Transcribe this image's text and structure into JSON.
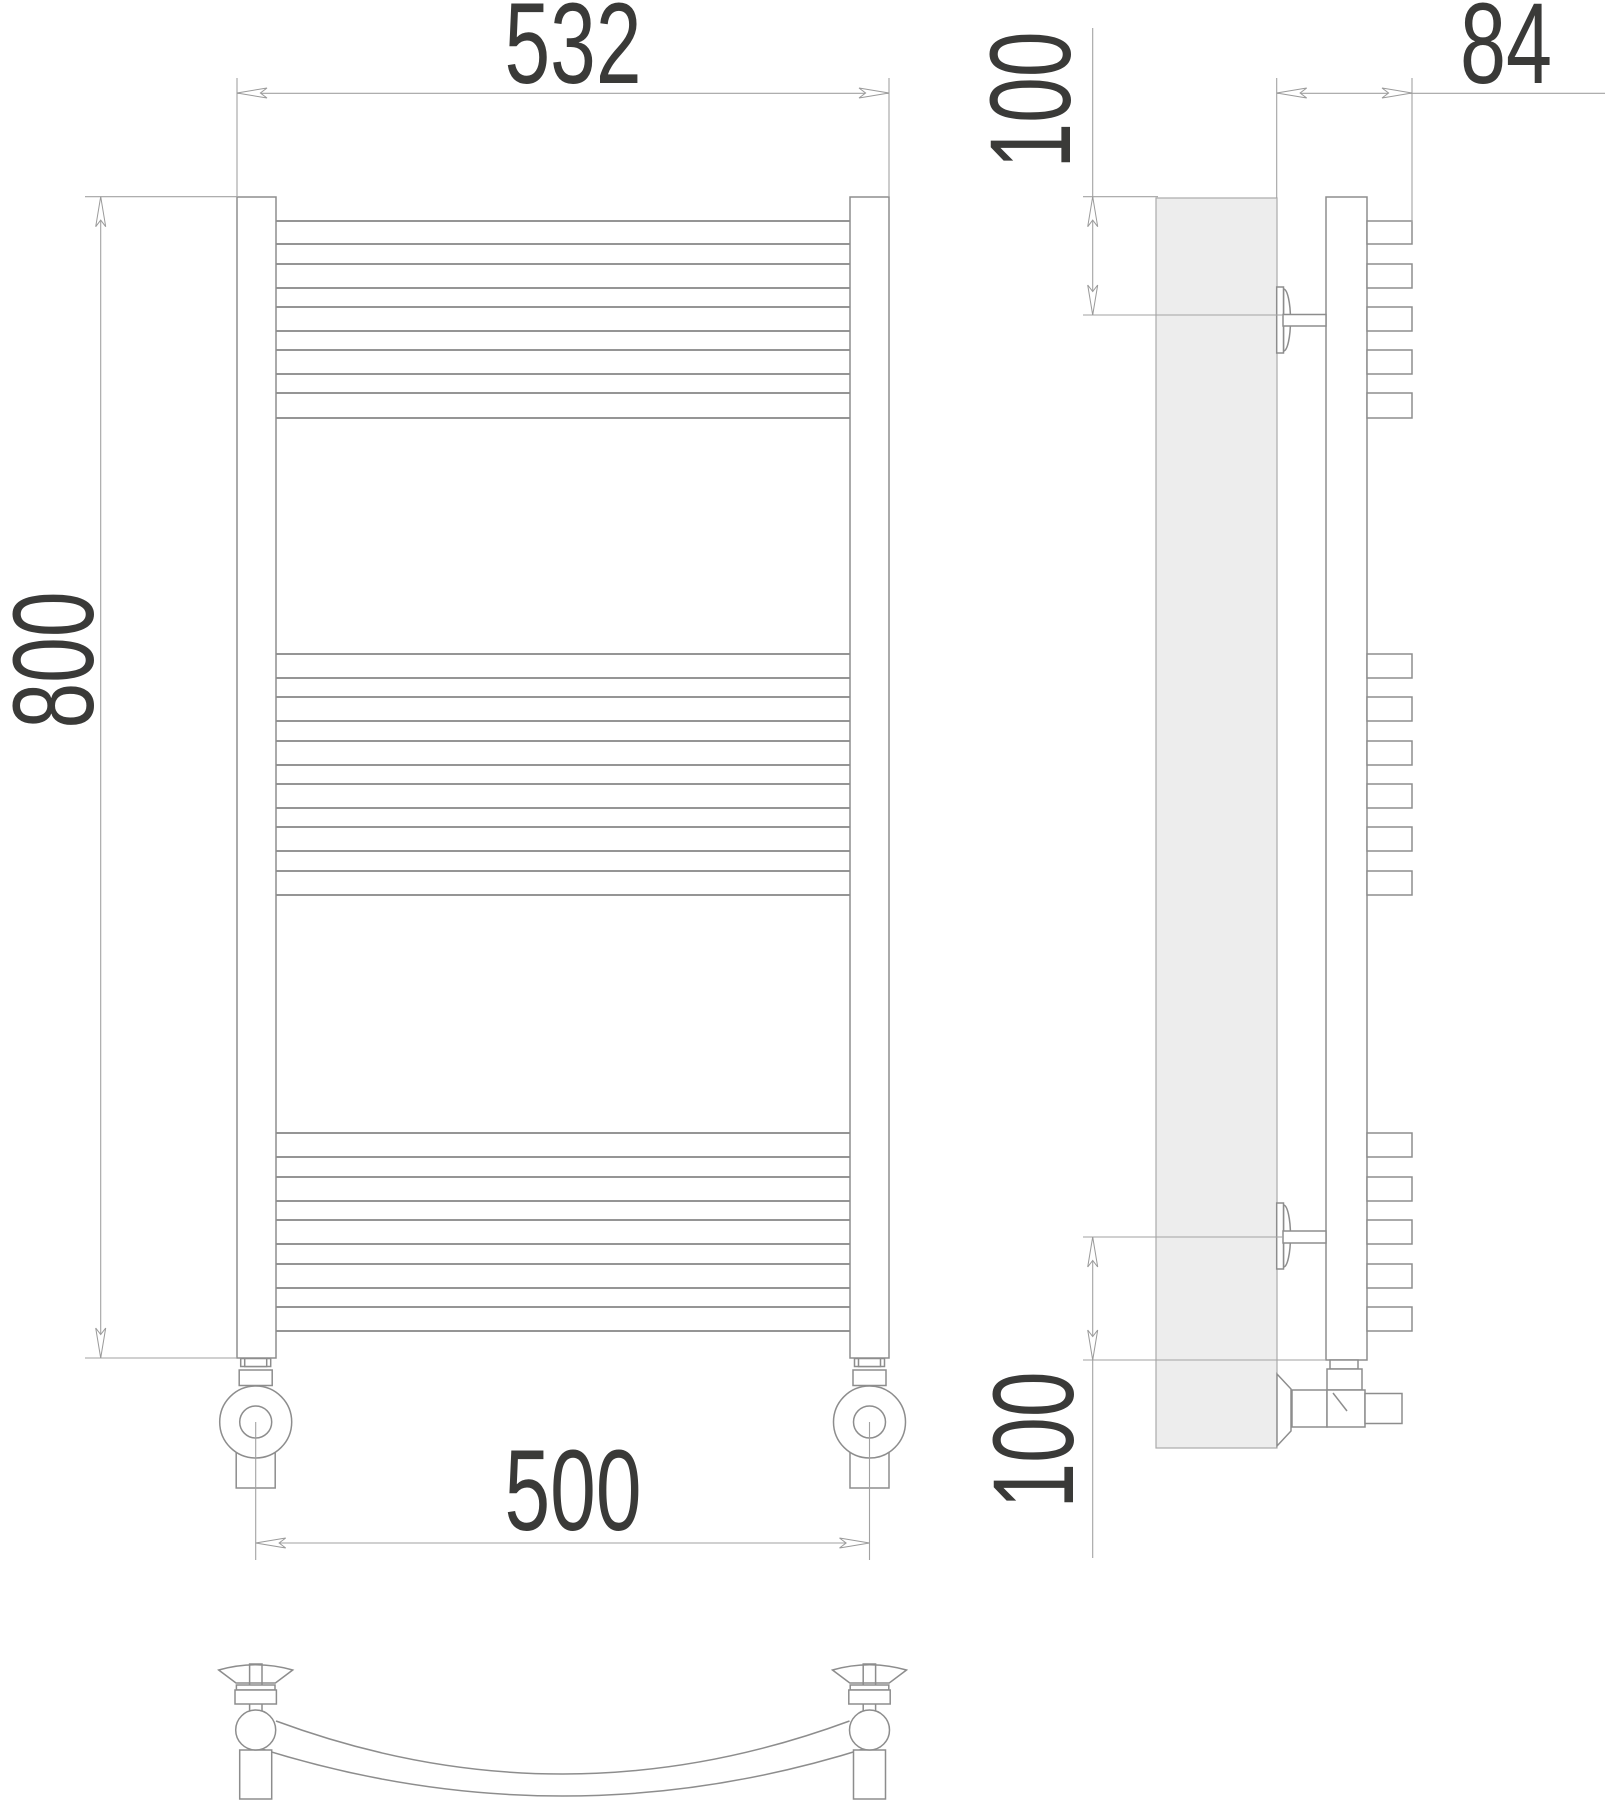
{
  "page": {
    "background": "#ffffff"
  },
  "dimensions": {
    "width_overall": {
      "label": "532"
    },
    "height": {
      "label": "800"
    },
    "connection_spacing": {
      "label": "500"
    },
    "depth": {
      "label": "84"
    },
    "mount_offset_top": {
      "label": "100"
    },
    "mount_offset_bottom": {
      "label": "100"
    }
  },
  "drawing": {
    "line_color": "#8d8d8d",
    "dim_color": "#a2a2a2",
    "text_color": "#3a3a38",
    "wall_fill": "#ededed",
    "front_view": {
      "rail_x": [
        237,
        850
      ],
      "rail_width": 39,
      "rail_top": 197,
      "rail_bottom": 1358,
      "rung_span": [
        276,
        850
      ],
      "rung_groups": [
        [
          [
            221,
            244
          ],
          [
            264,
            288
          ],
          [
            307,
            331
          ],
          [
            350,
            374
          ],
          [
            393,
            418
          ]
        ],
        [
          [
            654,
            678
          ],
          [
            697,
            721
          ],
          [
            741,
            765
          ],
          [
            784,
            808
          ],
          [
            827,
            851
          ],
          [
            871,
            895
          ]
        ],
        [
          [
            1133,
            1157
          ],
          [
            1177,
            1201
          ],
          [
            1220,
            1244
          ],
          [
            1264,
            1288
          ],
          [
            1307,
            1331
          ]
        ]
      ]
    },
    "side_view": {
      "box_x": 1367,
      "box_w": 45
    },
    "arrows": [
      {
        "x": 237,
        "y": 93,
        "dir": "left"
      },
      {
        "x": 889,
        "y": 93,
        "dir": "right"
      },
      {
        "x": 100.7,
        "y": 196.7,
        "dir": "up"
      },
      {
        "x": 100.7,
        "y": 1358,
        "dir": "down"
      },
      {
        "x": 1276.7,
        "y": 93,
        "dir": "left"
      },
      {
        "x": 1412,
        "y": 93,
        "dir": "right"
      },
      {
        "x": 1092.7,
        "y": 196.7,
        "dir": "up"
      },
      {
        "x": 1092.7,
        "y": 315,
        "dir": "down"
      },
      {
        "x": 1092.7,
        "y": 1237,
        "dir": "up"
      },
      {
        "x": 1092.7,
        "y": 1360,
        "dir": "down"
      },
      {
        "x": 255.7,
        "y": 1543,
        "dir": "left"
      },
      {
        "x": 869.5,
        "y": 1543,
        "dir": "right"
      }
    ]
  }
}
